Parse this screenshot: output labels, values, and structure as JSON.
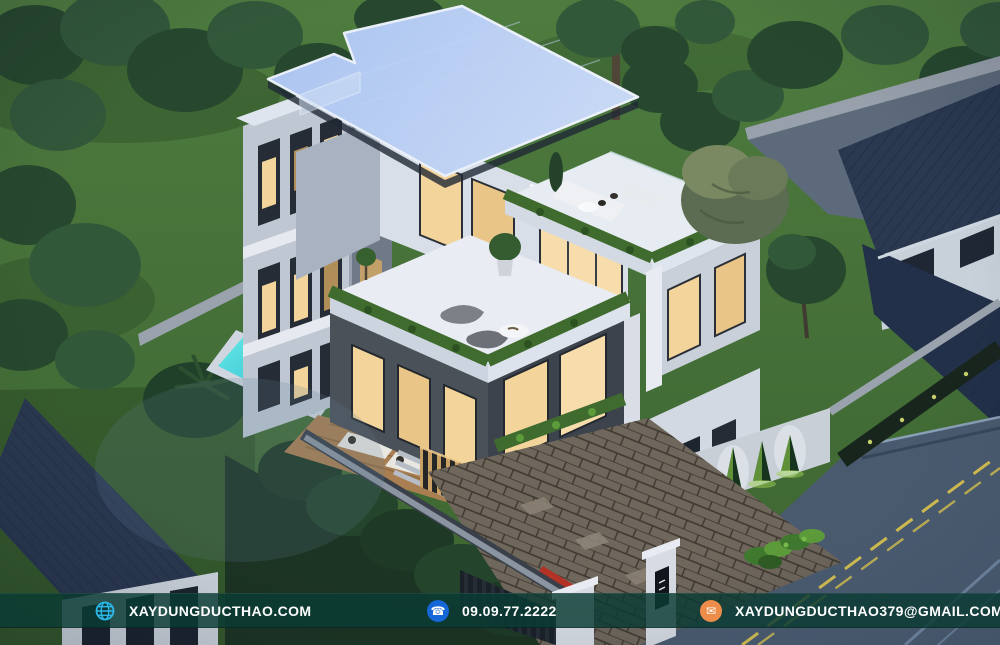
{
  "footer": {
    "website": {
      "icon": "globe-icon",
      "label": "XAYDUNGDUCTHAO.COM"
    },
    "phone": {
      "icon": "phone-icon",
      "label": "09.09.77.2222"
    },
    "email": {
      "icon": "mail-icon",
      "label": "XAYDUNGDUCTHAO379@GMAIL.COM"
    }
  },
  "colors": {
    "footer-bar": "rgba(10,58,51,0.82)",
    "footer-text": "#ffffff",
    "globe-icon": "#2cb7e9",
    "phone-icon": "#1566d6",
    "mail-icon": "#ee8c4a",
    "roof-blue": "#a9c3f0",
    "lawn-green": "#47743a",
    "tree-green-dark": "#27482e",
    "tree-green-mid": "#32583a",
    "pool-teal": "#3bcfd6",
    "window-warm": "#f3d49b",
    "wall-light": "#d9dfe8",
    "wall-shadow": "#a9b2c0",
    "cladding-dark": "#3d434c",
    "hedge-green": "#3f6b2e",
    "neighbor-roof-navy": "#2a3850",
    "road-gray": "#49596d",
    "lane-yellow": "#d8c352"
  }
}
